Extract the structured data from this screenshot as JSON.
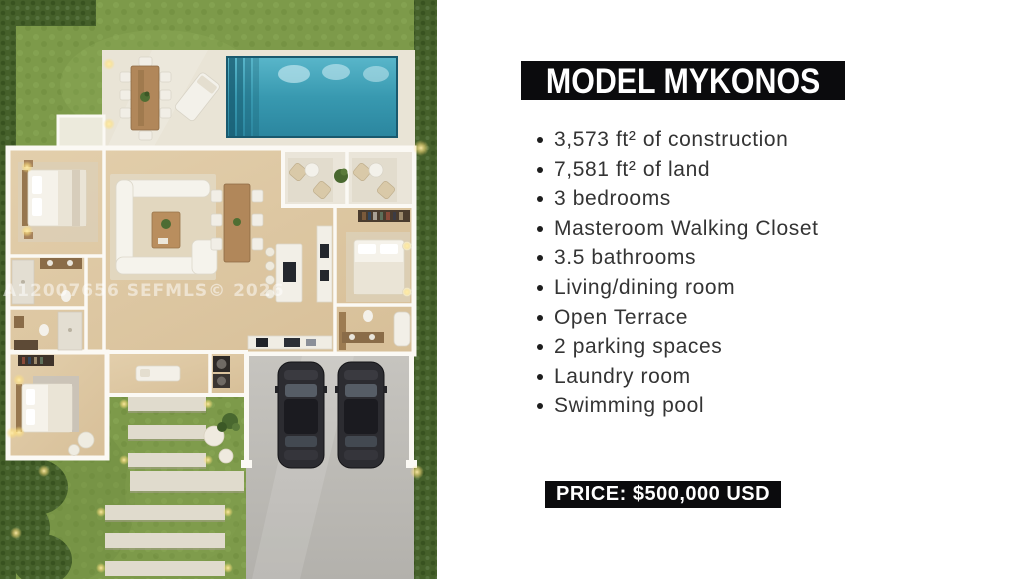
{
  "panel": {
    "title": "MODEL MYKONOS",
    "features": [
      "3,573 ft² of construction",
      "7,581 ft² of land",
      "3 bedrooms",
      "Masteroom Walking Closet",
      "3.5 bathrooms",
      "Living/dining room",
      "Open Terrace",
      "2 parking spaces",
      "Laundry room",
      "Swimming pool"
    ],
    "price_label": "PRICE: $500,000 USD"
  },
  "floor_plan": {
    "watermark": "A12007656 SEFMLS© 2026",
    "depicted_objects": [
      "swimming-pool",
      "outdoor-dining-set",
      "lounge-chair",
      "open-terrace-seating",
      "living-room-sofa",
      "dining-table",
      "kitchen-island",
      "master-bed",
      "bedroom-2-bed",
      "bedroom-3-bed",
      "bathrooms",
      "laundry-units",
      "two-parked-cars",
      "paver-walkway",
      "lawn-and-hedges"
    ]
  },
  "colors": {
    "banner_black": "#0b0b0d",
    "text_dark": "#343434",
    "pool_teal": "#3b9fb5",
    "grass_green": "#7d9a4a",
    "hedge_green": "#45602a",
    "deck_stone": "#e9e4d6",
    "wood_floor": "#ddc7a3",
    "driveway_grey": "#c0beb8",
    "car_black": "#2c2c31",
    "white": "#ffffff"
  }
}
